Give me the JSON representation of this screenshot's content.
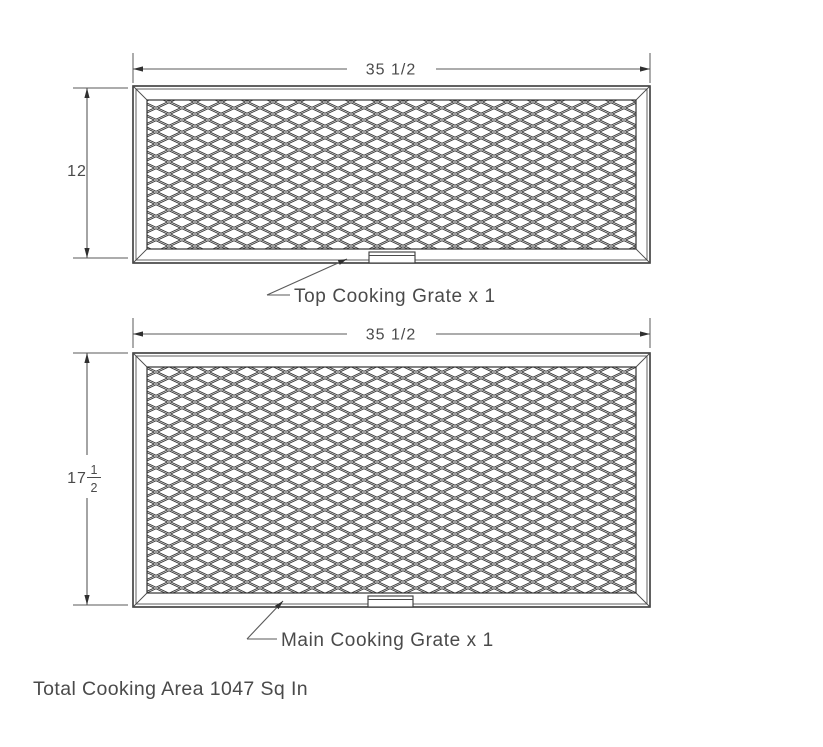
{
  "colors": {
    "line": "#5a5a5a",
    "frame": "#3a3a3a",
    "mesh": "#303030",
    "text": "#4a4a4a",
    "background": "#ffffff"
  },
  "top_grate": {
    "width_dim": "35 1/2",
    "height_dim": "12",
    "label": "Top Cooking Grate x 1"
  },
  "main_grate": {
    "width_dim": "35 1/2",
    "height_dim_whole": "17",
    "height_dim_numerator": "1",
    "height_dim_denominator": "2",
    "label": "Main Cooking Grate x 1"
  },
  "summary": {
    "total_cooking_area": "Total Cooking Area 1047 Sq In"
  }
}
